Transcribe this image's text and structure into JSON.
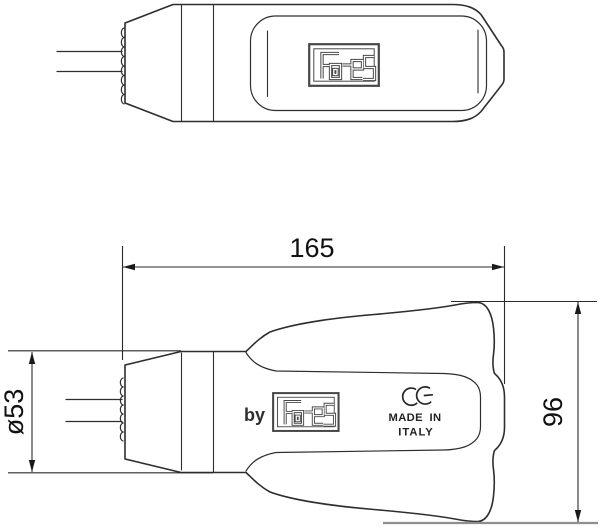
{
  "brand_logo_text": "Fa-es",
  "side_view": {
    "by_label": "by",
    "ce_mark": "CE",
    "made_in_line1": "MADE IN",
    "made_in_line2": "ITALY"
  },
  "dimensions": {
    "length_mm": "165",
    "height_mm": "96",
    "diameter_mm": "ø53"
  },
  "colors": {
    "outline": "#2e2e2e",
    "dimension_lines": "#2a2a2a",
    "gray_extension_line": "#8f8f8f",
    "logo_gray": "#474747",
    "background": "#ffffff"
  },
  "icons": {
    "faes_logo": "rectangular maze-lettering brand badge",
    "ce_mark": "CE conformity mark arcs"
  }
}
